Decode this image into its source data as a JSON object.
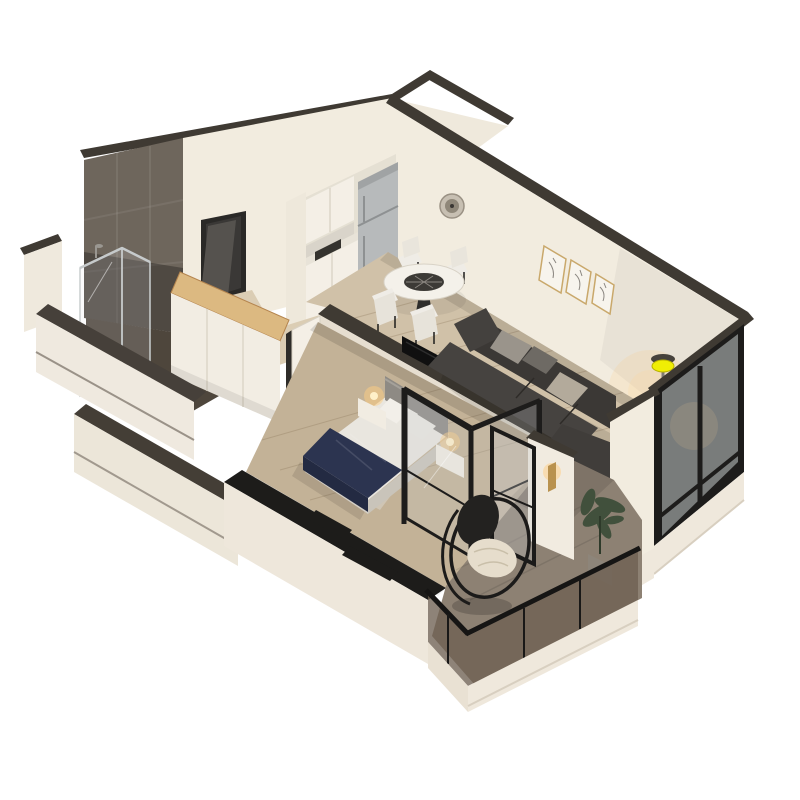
{
  "scene": {
    "title": "3D isometric cutaway floor plan render of a one-bedroom apartment",
    "background": "#ffffff",
    "rooms": [
      {
        "name": "kitchen",
        "items": [
          "tall-cabinet",
          "upper-cabinets",
          "counter-with-sink",
          "refrigerator",
          "round-wall-vent"
        ]
      },
      {
        "name": "dining-area",
        "items": [
          "round-table-glass-center",
          "four-white-chairs"
        ]
      },
      {
        "name": "living-room",
        "items": [
          "charcoal-corner-sofa",
          "throw-pillows",
          "three-framed-art-prints",
          "floor-lamp-lit-yellow",
          "black-framed-window-wall"
        ]
      },
      {
        "name": "bedroom",
        "items": [
          "double-bed",
          "navy-throw-blanket",
          "gray-headboard",
          "two-nightstands-lit",
          "wall-mounted-tv",
          "black-framed-glass-partition",
          "foot-bench"
        ]
      },
      {
        "name": "bathroom",
        "items": [
          "gray-tiled-wall",
          "walk-in-shower-glass",
          "white-door-ajar",
          "dark-tile-floor"
        ]
      },
      {
        "name": "hallway",
        "items": [
          "entrance-door-open-dark",
          "wardrobe-with-oak-top"
        ]
      },
      {
        "name": "balcony",
        "items": [
          "hanging-egg-chair",
          "potted-plant",
          "smoked-glass-railing",
          "brass-wall-sconce-lit",
          "black-framed-french-door"
        ]
      }
    ],
    "palette": {
      "wall_face": "#f2ecdf",
      "wall_cap": "#3f3a33",
      "wall_cap_black": "#1d1c1a",
      "tile": "#6e665c",
      "floor_wood": "#d0c1a8",
      "floor_wood_dark": "#c3b297",
      "floor_hall": "#dbcdb4",
      "floor_balcony": "#8d8173",
      "floor_bath": "#4e463c",
      "frame_black": "#1d1c1b",
      "glass_smoke": "rgba(110,96,82,0.78)",
      "sofa": "#3b3835",
      "pillow_gray": "#9a948b",
      "bed_white": "#e9e6df",
      "bed_throw_navy": "#2c3450",
      "headboard": "#8e8a84",
      "oak": "#dcb981",
      "steel": "#b7babb",
      "lamp_yellow": "#f0ee04",
      "glow_warm": "rgba(255,205,130,0.5)",
      "plant_green": "#41503c",
      "cushion_cream": "#e6ddcc",
      "art_frame": "#c9a86b",
      "door_dark": "#55524e"
    }
  }
}
